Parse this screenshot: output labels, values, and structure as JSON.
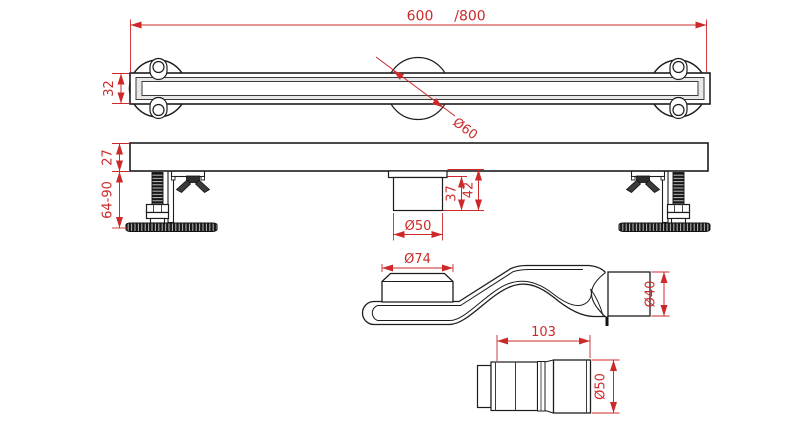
{
  "colors": {
    "background": "#ffffff",
    "object_line": "#1d1d1d",
    "inner_line": "#3a3a3a",
    "dimension": "#cc2a2a",
    "hardware_dark": "#2e2e2e"
  },
  "views": {
    "top": {
      "dim_length": "600",
      "dim_length_alt": "/800",
      "dim_channel_height": "32",
      "dim_center_hole_dia": "Ø60"
    },
    "side": {
      "dim_body_height": "27",
      "dim_foot_adjust_range": "64-90",
      "dim_outlet_pipe_depth": "37",
      "dim_outlet_total_depth": "42",
      "dim_outlet_dia": "Ø50"
    },
    "trap": {
      "dim_inlet_dia": "Ø74",
      "dim_outlet_dia": "Ø40"
    },
    "connector": {
      "dim_length": "103",
      "dim_dia": "Ø50"
    }
  }
}
